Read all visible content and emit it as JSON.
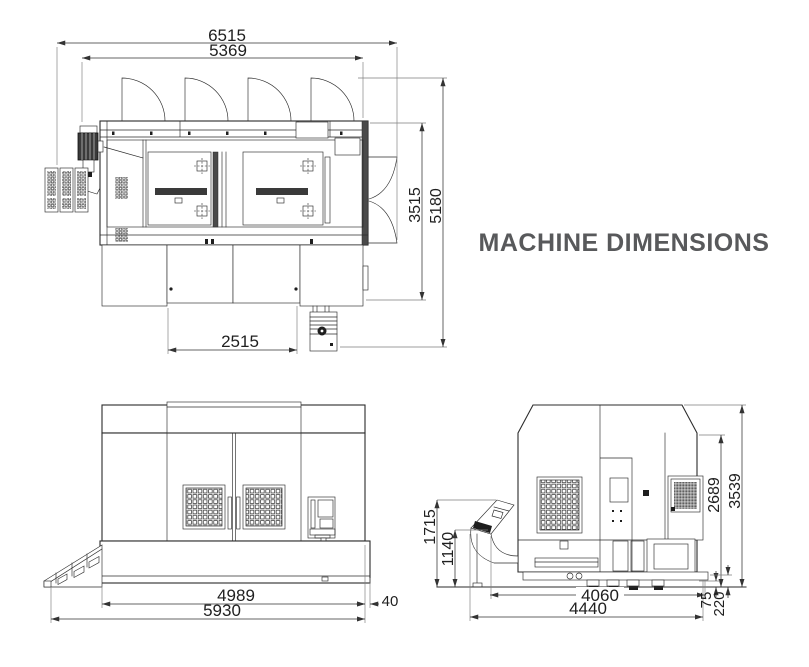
{
  "title": "MACHINE DIMENSIONS",
  "colors": {
    "line": "#2b2b2b",
    "dim_text": "#1f1f1f",
    "title": "#58595b"
  },
  "views": {
    "top": {
      "name": "top view",
      "dims": {
        "total_width": "6515",
        "body_width": "5369",
        "depth": "3515",
        "total_depth": "5180",
        "base_width": "2515"
      }
    },
    "front": {
      "name": "front view",
      "dims": {
        "body_width": "4989",
        "total_width": "5930",
        "base_offset": "40"
      }
    },
    "side": {
      "name": "side view",
      "dims": {
        "conveyor_height": "1715",
        "inlet_height": "1140",
        "shoulder_height": "2689",
        "total_height": "3539",
        "body_depth": "4060",
        "total_depth": "4440",
        "foot_height": "75",
        "base_height": "220"
      }
    }
  }
}
